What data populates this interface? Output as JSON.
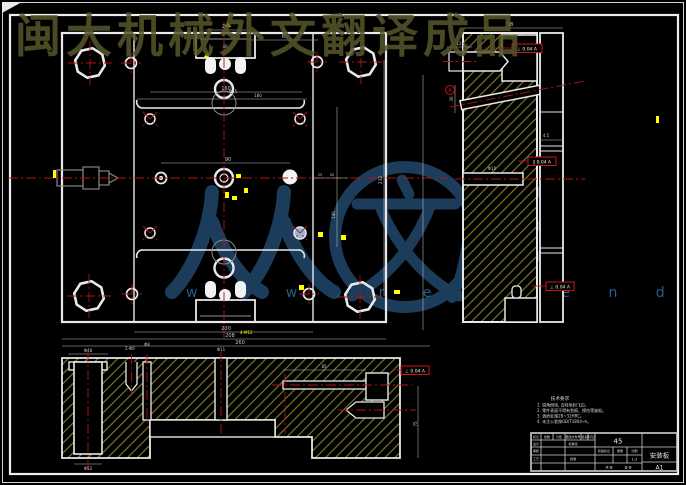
{
  "watermarks": {
    "top_text": "闽大机械外文翻译成品",
    "logo_text_renren": "人人",
    "logo_text_wen": "文",
    "logo_text_ku": "库",
    "url_text": "w w w . r e n r e n d o c . c o m",
    "colors": {
      "top": "#56562a",
      "logo": "#1d4160",
      "url": "#2e6ba8"
    }
  },
  "notes": {
    "heading": "技术要求",
    "line1": "1. 锐角倒钝, 去除毛刺飞边。",
    "line2": "2. 零件表面不得有划痕、擦伤等缺陷。",
    "line3": "3. 调质处理28~32HRC。",
    "line4": "4. 未注公差按GB/T1804-m。"
  },
  "title_block": {
    "material": "45",
    "part_name": "安装板",
    "sheet": "A1",
    "scale": "1:2",
    "labels": {
      "mark": "标记",
      "count": "处数",
      "zone": "分区",
      "change_no": "更改文件号",
      "sign": "签名",
      "date": "年月日",
      "design": "设计",
      "standardize": "标准化",
      "stage": "阶段标记",
      "weight": "质量",
      "scale": "比例",
      "check": "审核",
      "craft": "工艺",
      "approve": "批准",
      "total": "共 张",
      "page": "第 张"
    }
  },
  "gdt": {
    "g1": "⊥ 0.04 A",
    "g2": "∥ 0.04 A",
    "g3": "⊥ 0.04 A",
    "g4": "⊥ 0.04 A",
    "datum": "A"
  },
  "dims": {
    "d58": "58",
    "d25": "25",
    "d40": "40",
    "d65": "65",
    "d90": "90",
    "d160": "160",
    "d180": "180",
    "d200": "200",
    "d208": "208",
    "d260": "260",
    "d232": "232",
    "d140": "140",
    "d12": "12",
    "d45": "4.5",
    "d30": "30",
    "d75": "75",
    "d85": "85",
    "phi25": "Φ25",
    "phi10": "Φ10",
    "phi11": "Φ11",
    "phi48": "Φ48",
    "phi52": "Φ52",
    "phi8": "Φ8",
    "twophi6": "2-Φ6",
    "fourm12": "4-M12"
  }
}
